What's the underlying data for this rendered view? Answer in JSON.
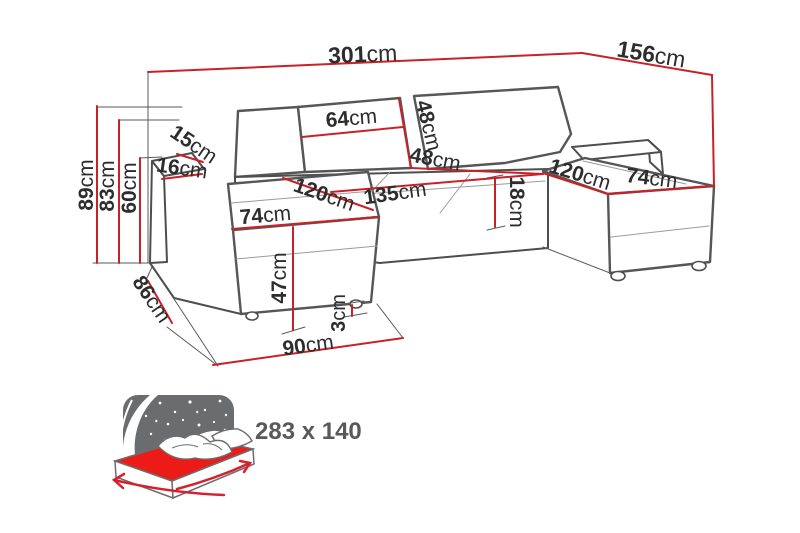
{
  "diagram_type": "sofa-dimension-diagram",
  "dimensions": {
    "total_width": {
      "value": "301",
      "unit": "cm"
    },
    "right_depth": {
      "value": "156",
      "unit": "cm"
    },
    "total_height": {
      "value": "89",
      "unit": "cm"
    },
    "armrest_height": {
      "value": "83",
      "unit": "cm"
    },
    "backrest_height": {
      "value": "60",
      "unit": "cm"
    },
    "armrest_top_width": {
      "value": "15",
      "unit": "cm"
    },
    "armrest_width": {
      "value": "16",
      "unit": "cm"
    },
    "back_cushion_width": {
      "value": "64",
      "unit": "cm"
    },
    "back_cushion_height": {
      "value": "48",
      "unit": "cm"
    },
    "seat_back_depth": {
      "value": "48",
      "unit": "cm"
    },
    "left_chaise_depth": {
      "value": "120",
      "unit": "cm"
    },
    "ottoman_width": {
      "value": "74",
      "unit": "cm"
    },
    "middle_seat_width": {
      "value": "135",
      "unit": "cm"
    },
    "seat_thickness": {
      "value": "18",
      "unit": "cm"
    },
    "right_chaise_depth": {
      "value": "120",
      "unit": "cm"
    },
    "right_chaise_width": {
      "value": "74",
      "unit": "cm"
    },
    "seat_height": {
      "value": "47",
      "unit": "cm"
    },
    "foot_height": {
      "value": "3",
      "unit": "cm"
    },
    "footprint_width": {
      "value": "90",
      "unit": "cm"
    },
    "footprint_depth": {
      "value": "86",
      "unit": "cm"
    }
  },
  "sleeping_area": {
    "label": "283 x 140"
  },
  "colors": {
    "dimension_red": "#c92128",
    "mattress_red": "#ed1b17",
    "outline_gray": "#4e4e4e",
    "night_gray": "#6b6c6e",
    "label_dark": "#2d2d2d",
    "sleeping_text_gray": "#58595b"
  }
}
